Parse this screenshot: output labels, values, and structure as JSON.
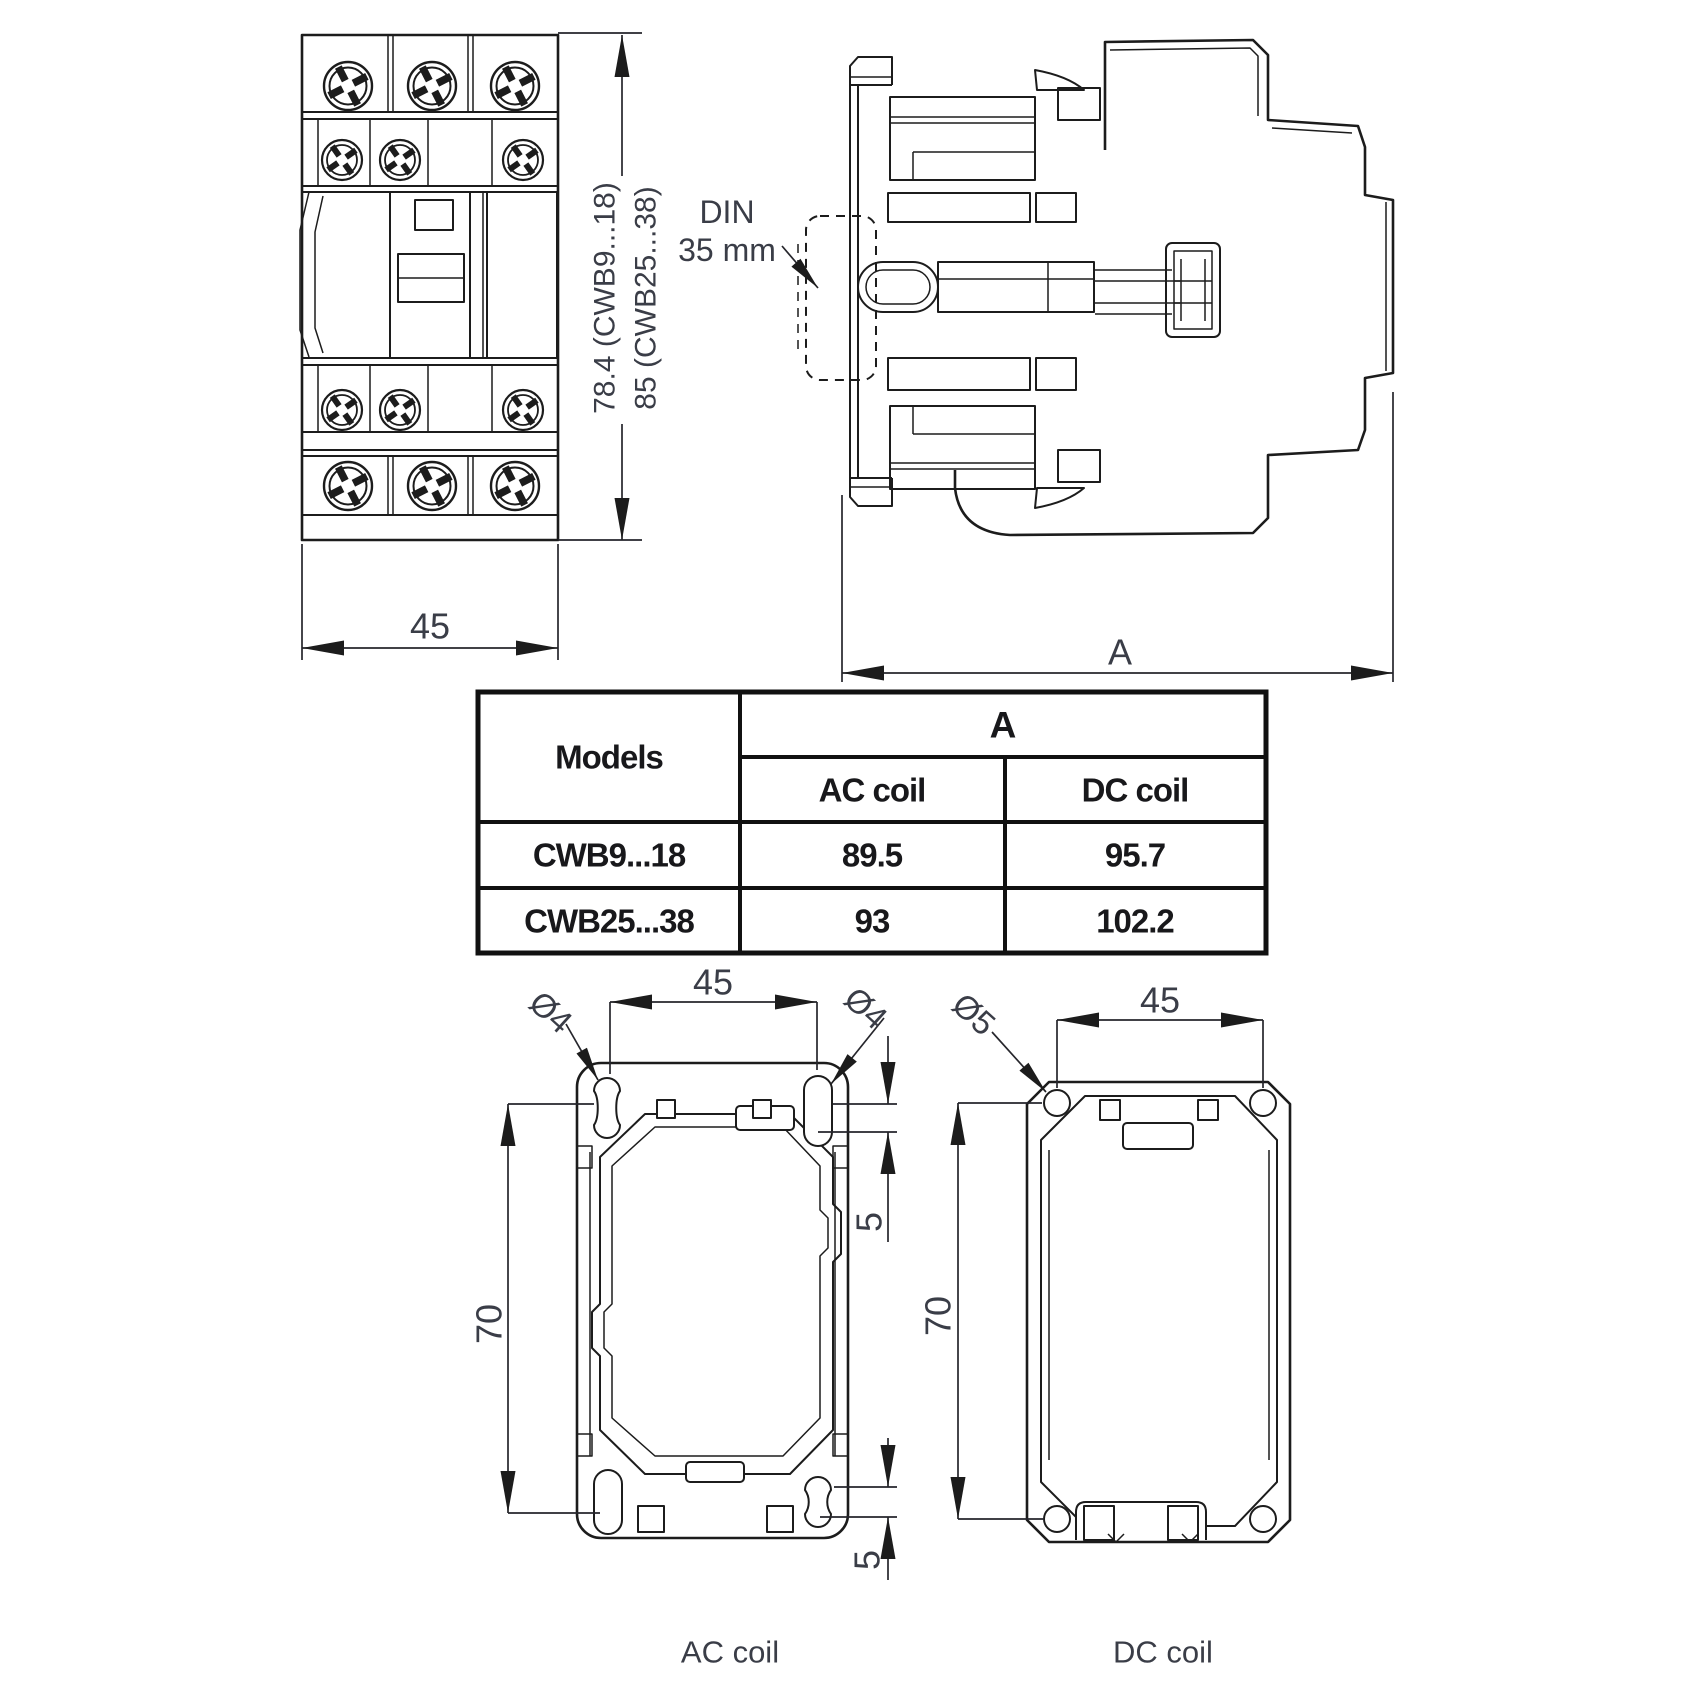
{
  "colors": {
    "line": "#1c1c1c",
    "dimension_text": "#3a3d47",
    "table_text": "#18181b",
    "background": "#ffffff"
  },
  "front_view": {
    "width_dim": "45",
    "height_dim_line1": "78.4 (CWB9...18)",
    "height_dim_line2": "85 (CWB25...38)"
  },
  "side_view": {
    "din_label_line1": "DIN",
    "din_label_line2": "35 mm",
    "depth_dim": "A"
  },
  "table": {
    "header_models": "Models",
    "header_a": "A",
    "header_ac": "AC coil",
    "header_dc": "DC coil",
    "rows": [
      {
        "model": "CWB9...18",
        "ac_coil": "89.5",
        "dc_coil": "95.7"
      },
      {
        "model": "CWB25...38",
        "ac_coil": "93",
        "dc_coil": "102.2"
      }
    ]
  },
  "ac_footprint": {
    "caption": "AC coil",
    "width_dim": "45",
    "height_dim": "70",
    "hole_left_dim": "Ø4",
    "hole_right_dim": "Ø4",
    "offset_top_dim": "5",
    "offset_bottom_dim": "5"
  },
  "dc_footprint": {
    "caption": "DC coil",
    "width_dim": "45",
    "height_dim": "70",
    "hole_dim": "Ø5"
  }
}
